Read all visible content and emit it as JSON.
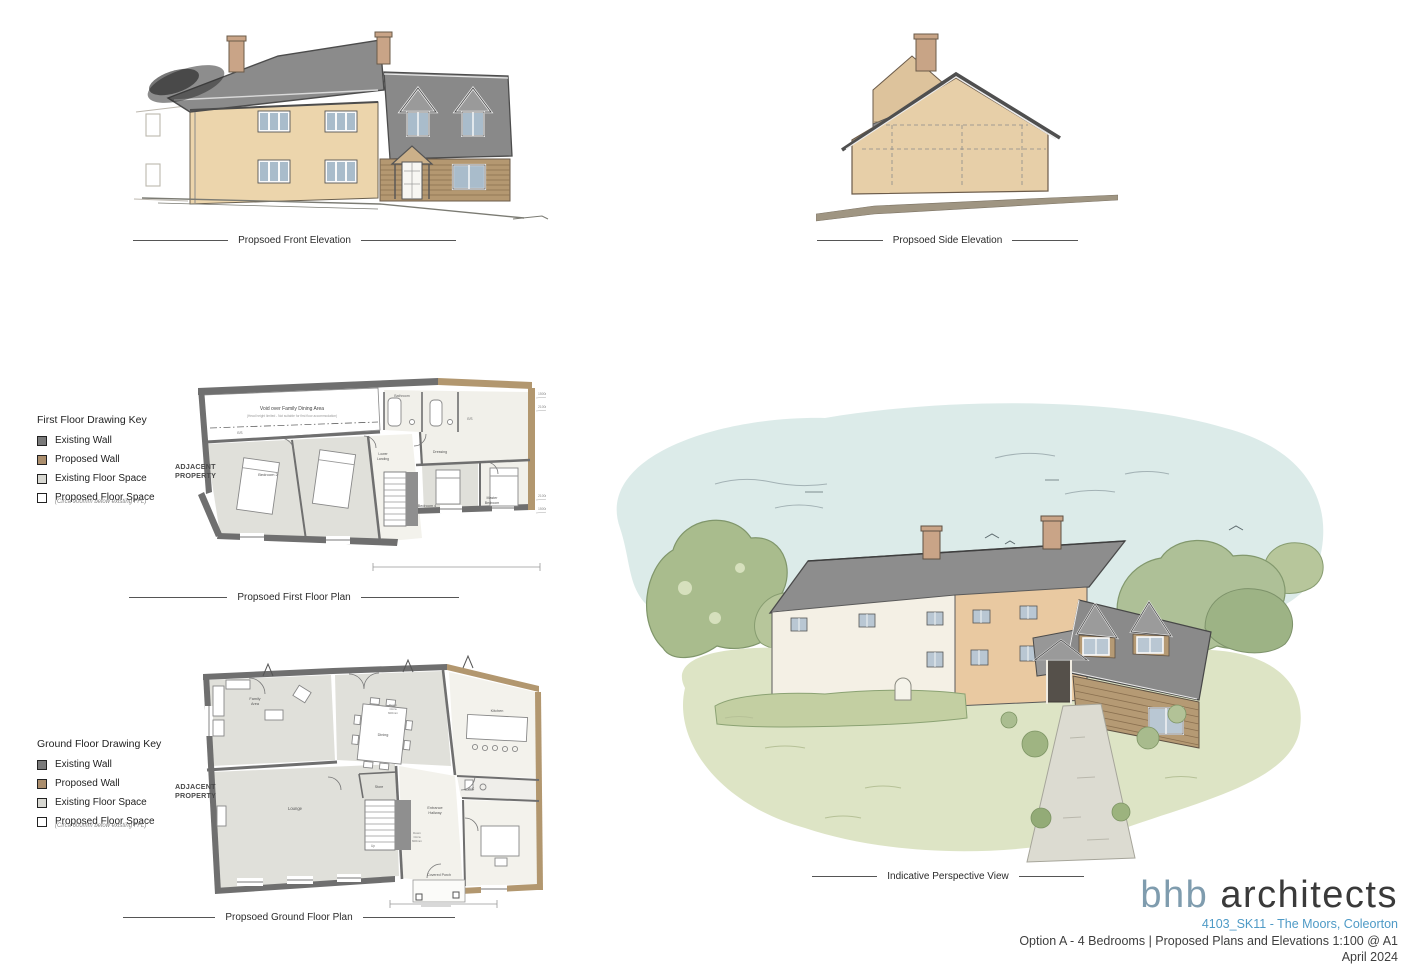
{
  "captions": {
    "front_elevation": "Propsoed Front Elevation",
    "side_elevation": "Propsoed Side Elevation",
    "first_floor_plan": "Propsoed First Floor Plan",
    "ground_floor_plan": "Propsoed Ground Floor Plan",
    "perspective_view": "Indicative Perspective View"
  },
  "keys": {
    "first_floor": {
      "title": "First Floor Drawing Key",
      "items": [
        {
          "label": "Existing Wall"
        },
        {
          "label": "Proposed Wall"
        },
        {
          "label": "Existing Floor Space"
        },
        {
          "label": "Proposed Floor Space",
          "note": "(Circa 900mm below existing FFL)"
        }
      ]
    },
    "ground_floor": {
      "title": "Ground Floor Drawing Key",
      "items": [
        {
          "label": "Existing Wall"
        },
        {
          "label": "Proposed Wall"
        },
        {
          "label": "Existing Floor Space"
        },
        {
          "label": "Proposed Floor Space",
          "note": "(Circa 600mm below existing FFL)"
        }
      ]
    }
  },
  "first_floor_plan": {
    "adjacent_property_line1": "ADJACENT",
    "adjacent_property_line2": "PROPERTY",
    "rooms": {
      "void_title": "Void over Family Dining Area",
      "void_note": "(Head height limited - Not suitable for first floor accommodation)",
      "bathroom": "Bathroom",
      "ensuite": "E/S",
      "lower_landing_1": "Lower",
      "lower_landing_2": "Landing",
      "dressing": "Dressing",
      "bedroom2": "Bedroom 2",
      "bedroom4": "Bedroom 4",
      "master_1": "Master",
      "master_2": "Bedroom"
    },
    "dims": [
      "1500mm HH",
      "2100mm HH",
      "2100mm HH",
      "1500mm HH"
    ]
  },
  "ground_floor_plan": {
    "adjacent_property_line1": "ADJACENT",
    "adjacent_property_line2": "PROPERTY",
    "rooms": {
      "family_1": "Family",
      "family_2": "Area",
      "dining": "Dining",
      "kitchen": "Kitchen",
      "down_1": "Down",
      "down_2": "Circa",
      "down_3": "600mm",
      "lounge": "Lounge",
      "store": "Store",
      "up": "Up",
      "entrance_1": "Entrance",
      "entrance_2": "Hallway",
      "wc": "W/C",
      "covered_porch": "Covered Porch"
    }
  },
  "titleblock": {
    "logo_primary": "bhb",
    "logo_secondary": "architects",
    "project_ref": "4103_SK11 - The Moors, Coleorton",
    "description": "Option A - 4 Bedrooms | Proposed Plans and Elevations 1:100 @ A1",
    "date": "April 2024"
  },
  "colors": {
    "render_wall": "#ecd5ac",
    "roof_grey": "#8b8b8b",
    "chimney_brick": "#c9a487",
    "timber_clad": "#b59a74",
    "existing_wall": "#6f6f6f",
    "proposed_wall": "#b2976f",
    "existing_floor": "#e0e0da",
    "sky_wash": "#dcebe9",
    "grass_wash": "#dde4c5",
    "tree_green": "#a9bc8d",
    "logo_blue": "#7f9cae",
    "ref_blue": "#4e9ac6"
  }
}
